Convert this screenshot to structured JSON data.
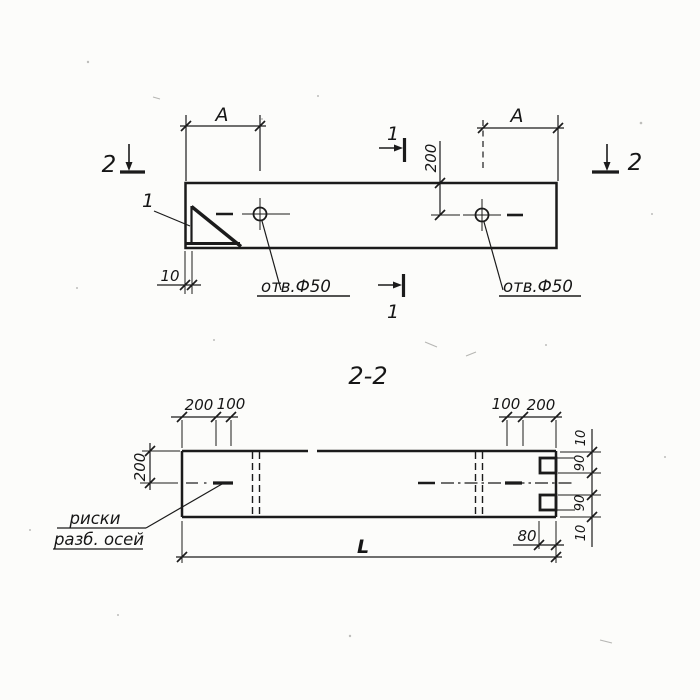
{
  "colors": {
    "ink": "#1b1b1b",
    "paper": "#fcfcfa"
  },
  "plan_view": {
    "section_cut_2_left": "2",
    "section_cut_2_right": "2",
    "section_cut_1_top": "1",
    "section_cut_1_bottom": "1",
    "detail_callout": "1",
    "dim_A_left": "A",
    "dim_A_right": "A",
    "dim_hole_from_edge": "200",
    "dim_corner_plate": "10",
    "hole_note_left": "отв.Ф50",
    "hole_note_right": "отв.Ф50"
  },
  "section_view": {
    "title": "2-2",
    "dim_top_left_200": "200",
    "dim_top_left_100": "100",
    "dim_top_right_100": "100",
    "dim_top_right_200": "200",
    "dim_height_200": "200",
    "dim_right_top_10": "10",
    "dim_right_upper_90": "90",
    "dim_right_lower_90": "90",
    "dim_right_bottom_10": "10",
    "dim_end_80": "80",
    "dim_length_L": "L",
    "axis_note_line1": "риски",
    "axis_note_line2": "разб. осей"
  }
}
